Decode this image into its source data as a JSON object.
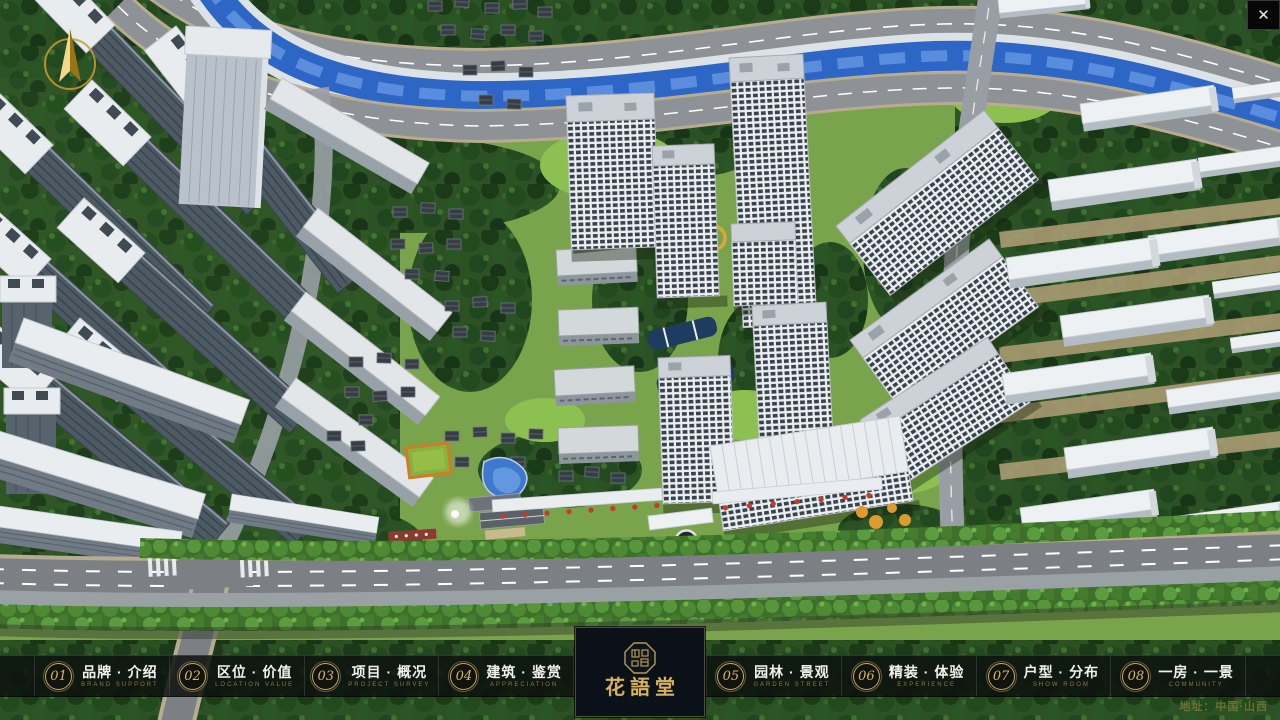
{
  "window": {
    "close": "✕"
  },
  "icons": {
    "compass": "north-compass",
    "logo_seal": "octagonal-seal",
    "close": "close-x"
  },
  "colors": {
    "accent_gold": "#c9a86a",
    "bar_background": "#0d110e",
    "river_blue": "#2e66c6"
  },
  "nav": {
    "items": [
      {
        "num": "01",
        "zh": "品牌 · 介绍",
        "en": "BRAND SUPPORT"
      },
      {
        "num": "02",
        "zh": "区位 · 价值",
        "en": "LOCATION VALUE"
      },
      {
        "num": "03",
        "zh": "项目 · 概况",
        "en": "PROJECT SURVEY"
      },
      {
        "num": "04",
        "zh": "建筑 · 鉴赏",
        "en": "APPRECIATION"
      },
      {
        "num": "05",
        "zh": "园林 · 景观",
        "en": "GARDEN STREET"
      },
      {
        "num": "06",
        "zh": "精装 · 体验",
        "en": "EXPERIENCE"
      },
      {
        "num": "07",
        "zh": "户型 · 分布",
        "en": "SHOW ROOM"
      },
      {
        "num": "08",
        "zh": "一房 · 一景",
        "en": "COMMUNITY"
      }
    ]
  },
  "logo": {
    "title": "花語堂",
    "caption": "· · · · · · · ·"
  },
  "footer": {
    "address": "地址：中国·山西"
  }
}
